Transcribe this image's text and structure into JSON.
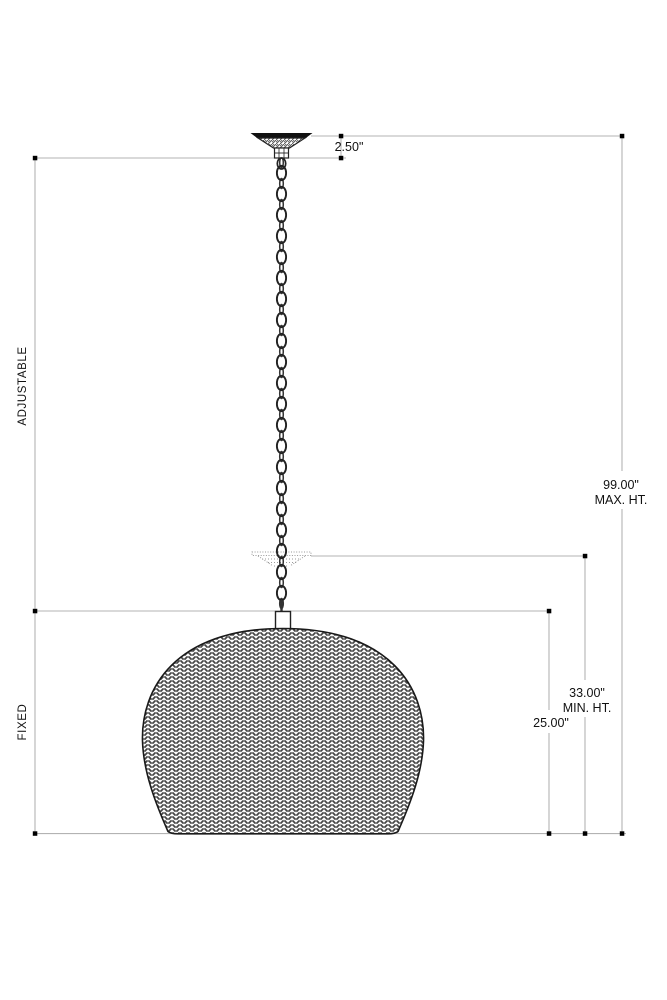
{
  "drawing": {
    "title": "pendant-light-fixture-dimension-drawing",
    "labels": {
      "adjustable": "ADJUSTABLE",
      "fixed": "FIXED"
    },
    "dimensions": {
      "canopy_height": "2.50\"",
      "max_height_value": "99.00\"",
      "max_height_label": "MAX. HT.",
      "min_height_value": "33.00\"",
      "min_height_label": "MIN. HT.",
      "shade_height": "25.00\""
    },
    "colors": {
      "dim_line": "#b3b3b3",
      "ink": "#1a1a1a",
      "texture": "#454545",
      "ghost": "#9a9a9a"
    }
  }
}
